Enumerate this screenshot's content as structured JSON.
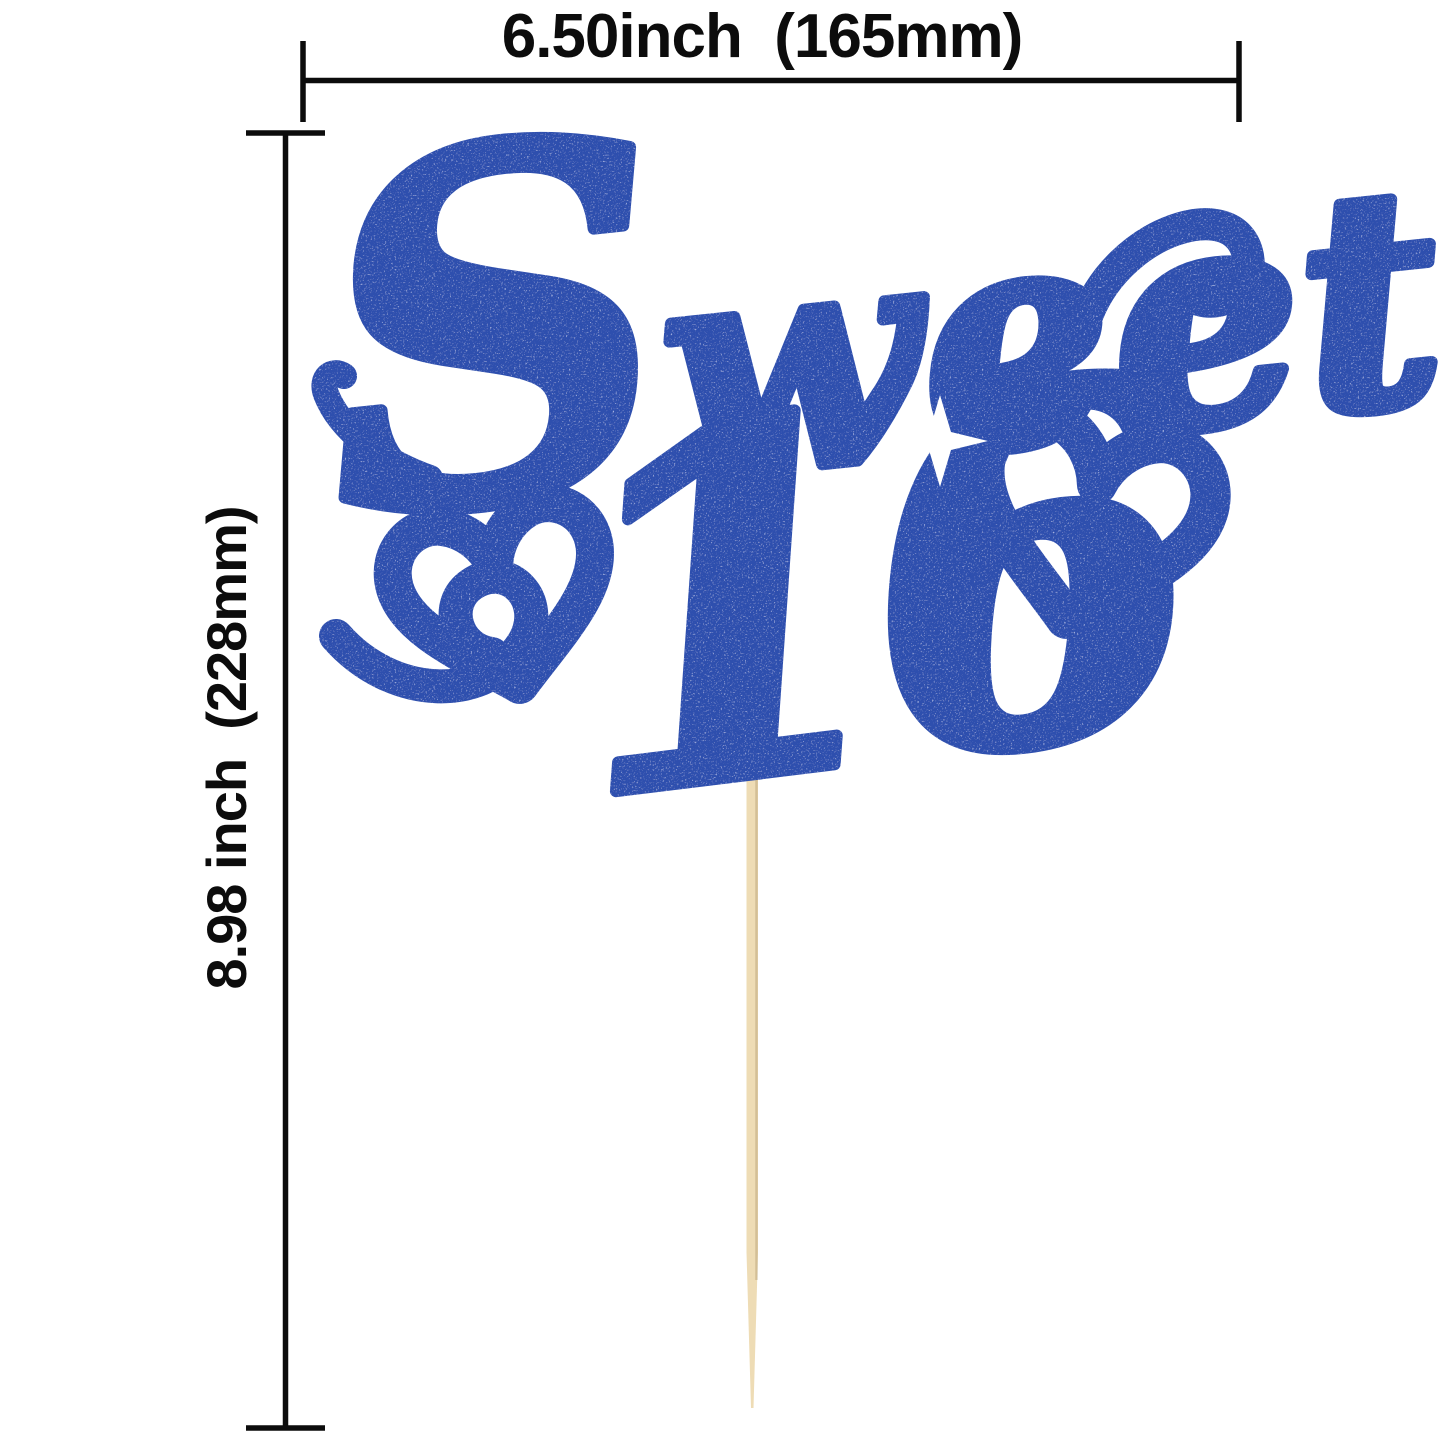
{
  "image": {
    "background": "#ffffff"
  },
  "dimensions": {
    "line_color": "#0c0c0c",
    "width_label": "6.50inch  (165mm)",
    "height_label": "8.98 inch  (228mm)"
  },
  "topper": {
    "word_initial": "S",
    "word_rest": "weet",
    "number": "16",
    "glitter_color": "#2e4fae",
    "sparkle_color": "#9db9f5",
    "heart_count": "2",
    "stick_color": "#eedcb5"
  }
}
